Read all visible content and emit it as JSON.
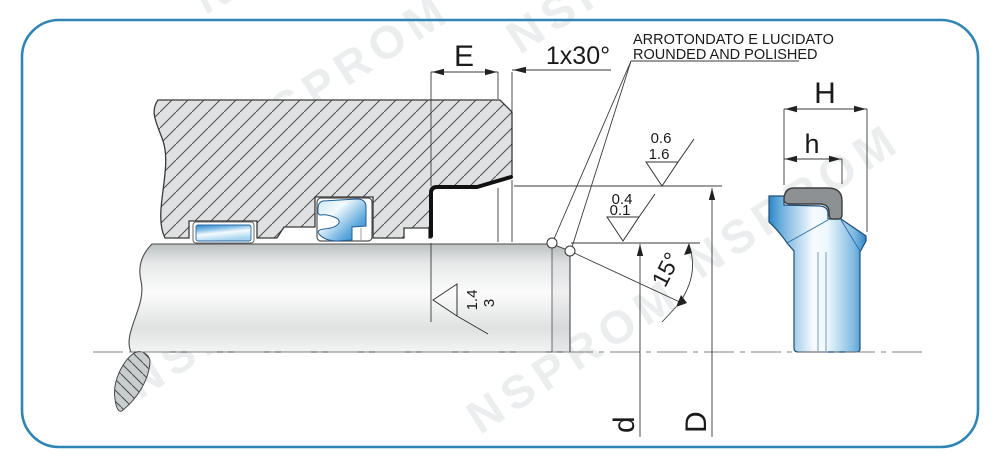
{
  "drawing": {
    "title": "Wiper seal installation drawing",
    "note_line1": "ARROTONDATO E LUCIDATO",
    "note_line2": "ROUNDED AND POLISHED",
    "dims": {
      "groove_depth": "E",
      "chamfer": "1x30°",
      "angle": "15°",
      "rod_diameter": "d",
      "bore_diameter": "D",
      "profile_height_total": "H",
      "profile_height_lip": "h"
    },
    "roughness": {
      "bore_value_top": "0.6",
      "bore_value_bottom": "1.6",
      "rod_value_top": "0.4",
      "rod_value_bottom": "0.1",
      "face_value_top": "1.4",
      "face_value_bottom": "3"
    },
    "watermark": "NSPROM",
    "colors": {
      "border_blue": "#2f86b5",
      "seal_blue": "#2e86c8",
      "case_gray": "#8d9194",
      "hatch_fill": "#e0e1e2"
    }
  }
}
